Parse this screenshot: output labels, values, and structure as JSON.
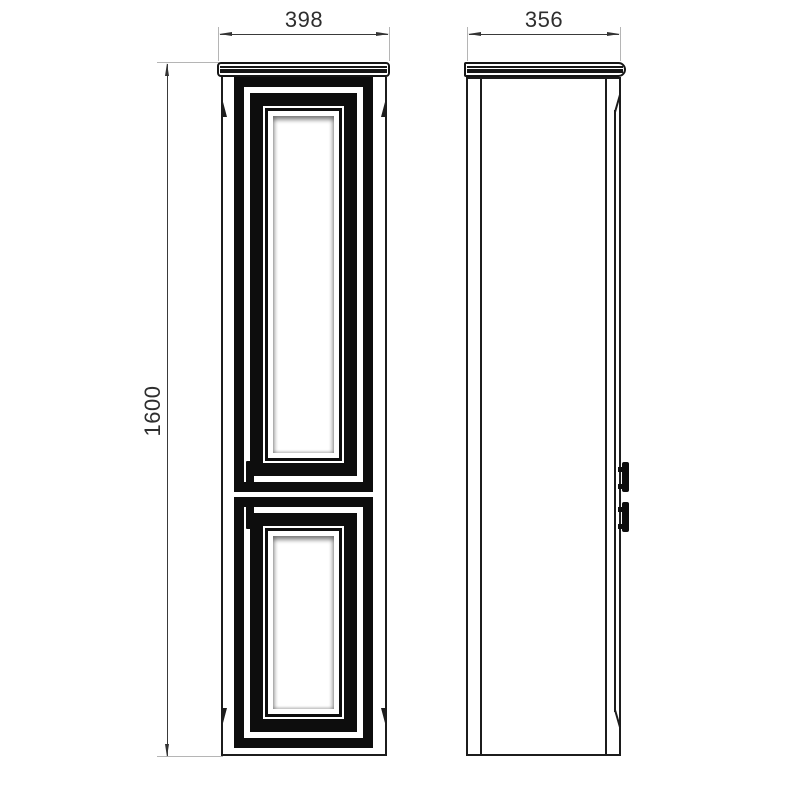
{
  "drawing": {
    "background_color": "#ffffff",
    "line_color": "#1c1c1c",
    "door_fill_color": "#0d0d0d",
    "dimension_text_color": "#2e2e2e",
    "extension_line_color": "#b5b5b5",
    "views": {
      "front": {
        "name": "front-view",
        "doors": [
          "upper-door",
          "lower-door"
        ]
      },
      "side": {
        "name": "side-view",
        "handles": 2
      }
    },
    "dimensions": {
      "width_label": "398",
      "depth_label": "356",
      "height_label": "1600"
    }
  }
}
